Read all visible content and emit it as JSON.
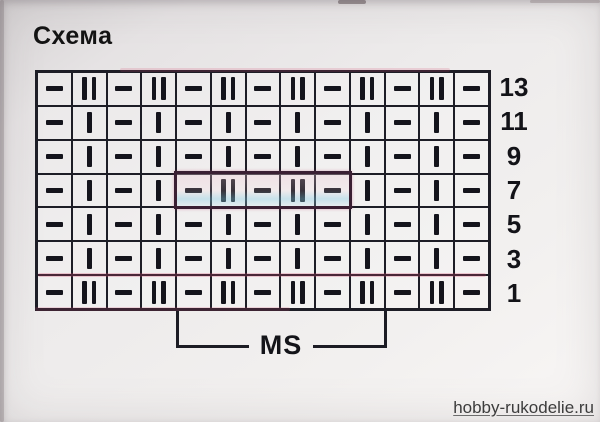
{
  "title": "Схема",
  "chart": {
    "columns": 13,
    "symbol_legend": {
      "d": "purl-dash",
      "b": "knit-bar",
      "B": "double-knit-bar"
    },
    "rows": [
      {
        "number": "13",
        "cells": [
          "d",
          "B",
          "d",
          "B",
          "d",
          "B",
          "d",
          "B",
          "d",
          "B",
          "d",
          "B",
          "d"
        ]
      },
      {
        "number": "11",
        "cells": [
          "d",
          "b",
          "d",
          "b",
          "d",
          "b",
          "d",
          "b",
          "d",
          "b",
          "d",
          "b",
          "d"
        ]
      },
      {
        "number": "9",
        "cells": [
          "d",
          "b",
          "d",
          "b",
          "d",
          "b",
          "d",
          "b",
          "d",
          "b",
          "d",
          "b",
          "d"
        ]
      },
      {
        "number": "7",
        "cells": [
          "d",
          "b",
          "d",
          "b",
          "d",
          "B",
          "d",
          "B",
          "d",
          "b",
          "d",
          "b",
          "d"
        ]
      },
      {
        "number": "5",
        "cells": [
          "d",
          "b",
          "d",
          "b",
          "d",
          "b",
          "d",
          "b",
          "d",
          "b",
          "d",
          "b",
          "d"
        ]
      },
      {
        "number": "3",
        "cells": [
          "d",
          "b",
          "d",
          "b",
          "d",
          "b",
          "d",
          "b",
          "d",
          "b",
          "d",
          "b",
          "d"
        ]
      },
      {
        "number": "1",
        "cells": [
          "d",
          "B",
          "d",
          "B",
          "d",
          "B",
          "d",
          "B",
          "d",
          "B",
          "d",
          "B",
          "d"
        ]
      }
    ],
    "repeat_box": {
      "row": "7",
      "start_col": 5,
      "end_col": 9
    }
  },
  "bracket": {
    "label": "MS"
  },
  "watermark": {
    "text": "hobby-rukodelie.ru"
  },
  "colors": {
    "line": "#1d1d26",
    "paper": "#edebeb",
    "highlight_pink": "#eec3d0",
    "highlight_blue": "#87cde4"
  }
}
